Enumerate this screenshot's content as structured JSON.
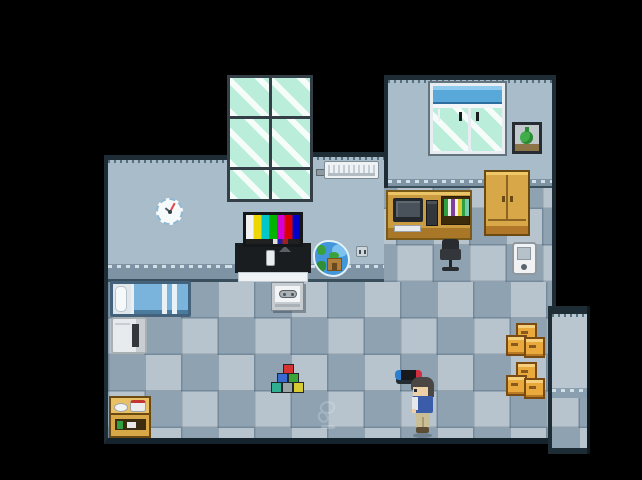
{
  "scene": {
    "description": "Top-down pixel-art RPG interior: bedroom/office with checkered blue-gray tile floor, black void around the room",
    "visible_text": [],
    "player": {
      "appearance": "dark hair, blue top with white front, khaki pants",
      "facing": "left",
      "location": "lower-right floor, next to game console"
    },
    "watermark": {
      "present": true,
      "style": "faint light glyph with small bar, on a floor tile lower-center"
    }
  },
  "palette": {
    "background": "#000000",
    "wall": "#a9bcc9",
    "wall_border": "#1e2c36",
    "wall_ledge": "#7e93a4",
    "floor_light": "#b7c3cd",
    "floor_dark": "#8ea2b2",
    "glass_mint": "#baeeda",
    "blind_blue": "#58a8da",
    "wood": "#d8a848",
    "crate_orange": "#e9a93c",
    "water_blue": "#4496da",
    "blanket_blue": "#7ab4dc",
    "tv_color_bars": [
      "#f2f2f2",
      "#ecd800",
      "#00c8c8",
      "#00b400",
      "#d400d4",
      "#d80000",
      "#0000c8"
    ],
    "toy_block_colors": [
      "#d63333",
      "#3a6ad0",
      "#3aa63a",
      "#2fae92",
      "#9aa3a6",
      "#d8ca33"
    ],
    "console_joycon_left": "#2b7fd0",
    "console_joycon_right": "#cf2f3e"
  },
  "objects": [
    {
      "id": "large-window",
      "label": "Tall six-pane mint-glass window",
      "location": "top center wall column"
    },
    {
      "id": "wall-clock",
      "label": "Round analog wall clock",
      "location": "left wall"
    },
    {
      "id": "air-conditioner",
      "label": "Wall-mounted AC unit with pipe",
      "location": "center wall"
    },
    {
      "id": "tv",
      "label": "TV showing SMPTE color test bars",
      "location": "on black TV cabinet below window"
    },
    {
      "id": "tv-cabinet",
      "label": "Black TV stand with white base shelf and remote",
      "location": "below window"
    },
    {
      "id": "aquarium",
      "label": "Fish tank with plants and castle",
      "location": "right of TV stand"
    },
    {
      "id": "power-outlet",
      "label": "Small wall outlet",
      "location": "center wall, lower right"
    },
    {
      "id": "blind-window",
      "label": "Window with blue roller blind and pull cords",
      "location": "top-right wall"
    },
    {
      "id": "framed-picture",
      "label": "Framed picture of a green flask/bag",
      "location": "top-right wall, right of window"
    },
    {
      "id": "computer-desk",
      "label": "Wooden desk with monitor, tower, keyboard and book shelf",
      "location": "upper-right floor"
    },
    {
      "id": "wardrobe",
      "label": "Tall wooden two-door wardrobe",
      "location": "against top-right wall"
    },
    {
      "id": "office-chair",
      "label": "Black office chair",
      "location": "in front of desk"
    },
    {
      "id": "handheld-device",
      "label": "White handheld phone/device",
      "location": "upper-right floor"
    },
    {
      "id": "bed",
      "label": "Bed with white pillow and blue striped blanket",
      "location": "left side of main floor"
    },
    {
      "id": "washing-machine",
      "label": "White appliance with dark slot",
      "location": "below bed"
    },
    {
      "id": "dish-shelf",
      "label": "Wooden shelf with bowl, red-rimmed pot and small goods",
      "location": "bottom-left corner"
    },
    {
      "id": "gamepad-sign",
      "label": "Small sign/card with gamepad icon",
      "location": "floor below TV"
    },
    {
      "id": "toy-blocks",
      "label": "Pyramid of six colored toy blocks",
      "location": "center floor"
    },
    {
      "id": "game-console",
      "label": "Game console with blue and red ends",
      "location": "floor, left of player"
    },
    {
      "id": "player-character",
      "label": "Player character sprite",
      "location": "lower-right floor"
    },
    {
      "id": "cardboard-boxes-upper",
      "label": "Stack of three wooden crates",
      "location": "right floor"
    },
    {
      "id": "cardboard-boxes-lower",
      "label": "Stack of three wooden crates",
      "location": "right floor, below first stack"
    },
    {
      "id": "side-alcove",
      "label": "Narrow alcove/hallway extension",
      "location": "right edge of room"
    },
    {
      "id": "floor-watermark",
      "label": "Faint watermark glyph",
      "location": "floor tile lower-center"
    }
  ]
}
